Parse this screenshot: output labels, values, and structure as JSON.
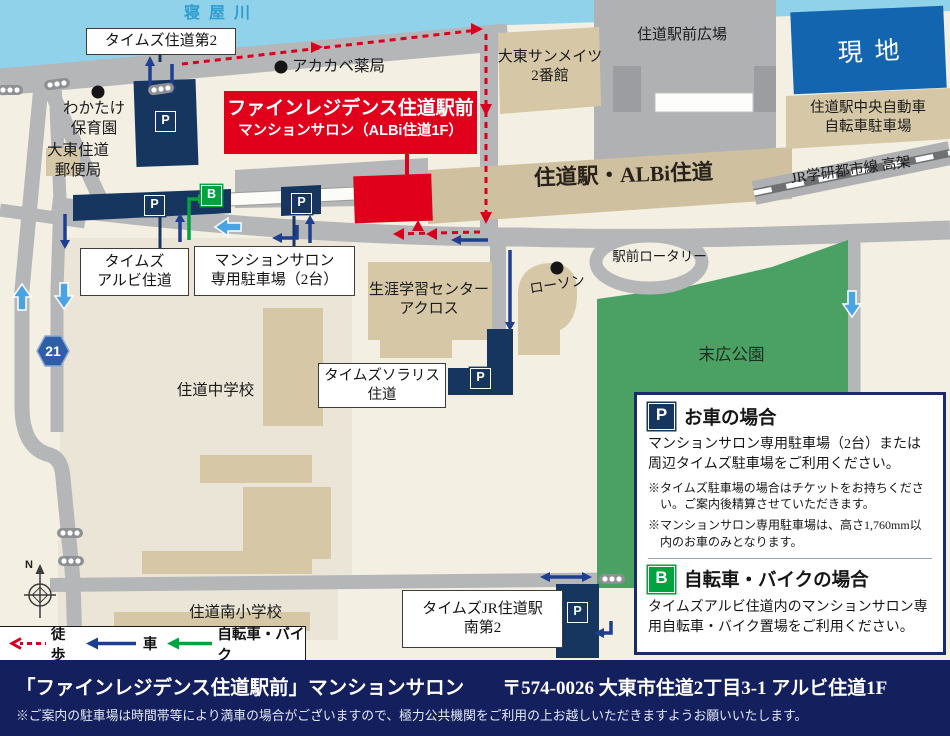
{
  "map": {
    "river_label": "寝屋川",
    "places": {
      "times_suminodo2": "タイムズ住道第2",
      "akakabe_pharmacy": "アカカベ薬局",
      "wakatake_nursery": "わかたけ\n保育園",
      "post_office": "大東住道\n郵便局",
      "sunmates": "大東サンメイツ\n2番館",
      "station_plaza": "住道駅前広場",
      "site": "現地",
      "chuo_bicycle_parking": "住道駅中央自動車\n自転車駐車場",
      "jr_line": "JR学研都市線 高架",
      "station": "住道駅・ALBi住道",
      "times_albi": "タイムズ\nアルビ住道",
      "salon_parking": "マンションサロン\n専用駐車場（2台）",
      "rotary": "駅前ロータリー",
      "lawson": "ローソン",
      "across_center": "生涯学習センター\nアクロス",
      "suehiro_park": "末広公園",
      "times_solaris": "タイムズソラリス\n住道",
      "junior_high": "住道中学校",
      "elementary": "住道南小学校",
      "times_jr_minami2": "タイムズJR住道駅\n南第2"
    },
    "badges": {
      "parking": "P",
      "bicycle": "B",
      "route_number": "21",
      "compass_north": "N"
    }
  },
  "salon_callout": {
    "line1": "ファインレジデンス住道駅前",
    "line2": "マンションサロン（ALBi住道1F）"
  },
  "legend": {
    "walk": "徒歩",
    "car": "車",
    "bicycle": "自転車・バイク"
  },
  "info_box": {
    "car": {
      "badge": "P",
      "title": "お車の場合",
      "body": "マンションサロン専用駐車場（2台）または周辺タイムズ駐車場をご利用ください。",
      "notes": [
        "※タイムズ駐車場の場合はチケットをお持ちください。ご案内後精算させていただきます。",
        "※マンションサロン専用駐車場は、高さ1,760mm以内のお車のみとなります。"
      ]
    },
    "bicycle": {
      "badge": "B",
      "title": "自転車・バイクの場合",
      "body": "タイムズアルビ住道内のマンションサロン専用自転車・バイク置場をご利用ください。"
    }
  },
  "footer": {
    "name": "「ファインレジデンス住道駅前」マンションサロン",
    "address": "〒574-0026 大東市住道2丁目3-1 アルビ住道1F",
    "note": "※ご案内の駐車場は時間帯等により満車の場合がございますので、極力公共機関をご利用の上お越しいただきますようお願いいたします。"
  },
  "colors": {
    "accent_red": "#e0001b",
    "navy_building": "#17365f",
    "bicycle_green": "#00a33e",
    "park_green": "#4ba163",
    "site_blue": "#1465b0",
    "footer_navy": "#141f5e",
    "river_blue": "#8fd2ea"
  }
}
